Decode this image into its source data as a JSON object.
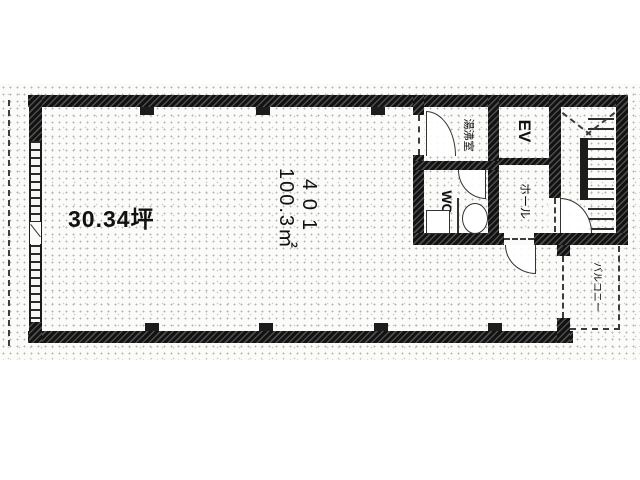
{
  "plan": {
    "area_tsubo_label": "30.34坪",
    "unit_number": "401",
    "area_sqm": "100.3㎡",
    "rooms": {
      "elevator": "EV",
      "hall": "ホール",
      "kitchenette": "湯沸室",
      "toilet": "WC",
      "balcony": "バルコニー"
    }
  },
  "colors": {
    "ink": "#111111",
    "paper": "#ffffff",
    "stipple_dot": "#b4b4ae"
  }
}
